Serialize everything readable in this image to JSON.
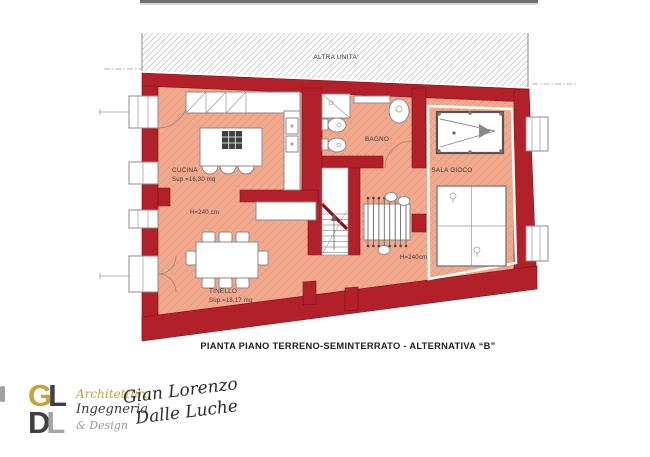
{
  "colors": {
    "wall": "#b2202a",
    "wall_outline": "#7e1118",
    "floor": "#f3a78b",
    "floor_line": "#e18e6d",
    "furniture_stroke": "#8b8b8b",
    "hatch_line": "#c9c9c9",
    "text": "#333333",
    "gold": "#c8a23a",
    "dark_gray": "#414042",
    "light_gray": "#a5a5a8"
  },
  "plan": {
    "upper_area_label": "ALTRA UNITA'",
    "rooms": {
      "cucina": {
        "name": "CUCINA",
        "area": "Sup.=16,30 mq",
        "height_note": "H=240 cm"
      },
      "tinello": {
        "name": "TINELLO",
        "area": "Sup.=18,17 mq"
      },
      "bagno": {
        "name": "BAGNO"
      },
      "sala_gioco": {
        "name": "SALA GIOCO",
        "height_note": "H=240cm"
      }
    },
    "caption": "PIANTA PIANO TERRENO-SEMINTERRATO - ALTERNATIVA “B”"
  },
  "branding": {
    "monogram": {
      "letter_g": "G",
      "letter_l1": "L",
      "letter_d": "D",
      "letter_l2": "L"
    },
    "tagline": {
      "line1": "Architettura",
      "line2": "Ingegneria",
      "line3": "& Design"
    },
    "signature": {
      "line1": "Gian Lorenzo",
      "line2": "Dalle Luche"
    }
  }
}
